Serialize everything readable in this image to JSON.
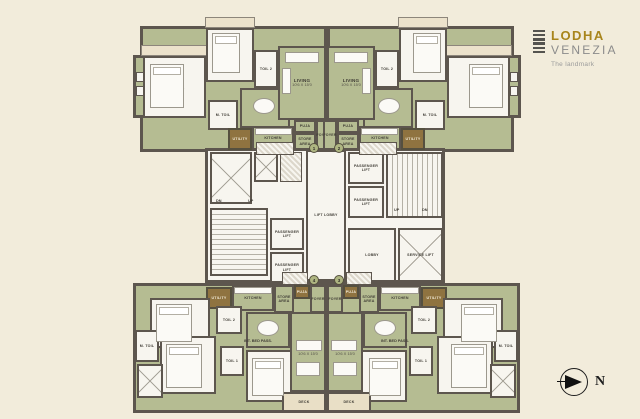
{
  "brand": {
    "line1": "LODHA",
    "line2": "VENEZIA",
    "tagline": "The landmark"
  },
  "compass": {
    "label": "N"
  },
  "flat_numbers": {
    "top_left": "1",
    "top_right": "2",
    "bottom_left": "4",
    "bottom_right": "3"
  },
  "rooms": {
    "m_bed": {
      "label": "M. BED",
      "dims": "11'0 X 10'0"
    },
    "bed2": {
      "label": "BED 2",
      "dims": "10'0 X 11'3"
    },
    "bed3": {
      "label": "BED 3",
      "dims": "10'0 X 10'6"
    },
    "toil1": {
      "label": "TOIL 1",
      "dims": "5'0 X 8'0"
    },
    "toil2": {
      "label": "TOIL 2",
      "dims": "5'0 X 8'0"
    },
    "m_toil": {
      "label": "M. TOIL",
      "dims": "5'0 X 8'0"
    },
    "living": {
      "label": "LIVING",
      "dims": "10'6 X 15'0"
    },
    "dining": {
      "label": "DINING",
      "dims": "8'0 X 8'6"
    },
    "kitchen": {
      "label": "KITCHEN",
      "dims": "10'6 X 8'0"
    },
    "utility": {
      "label": "UTILITY"
    },
    "puja": {
      "label": "PUJA"
    },
    "store": {
      "label": "STORE\nAREA"
    },
    "foyer": {
      "label": "FOYER"
    },
    "deck": {
      "label": "DECK",
      "dims": "10'0 X 4'0"
    },
    "pass": {
      "label": "INT. BED PASS."
    }
  },
  "core": {
    "passenger_lift": "PASSENGER\nLIFT",
    "service_lift": "SERVICE LIFT",
    "lift_lobby": "LIFT LOBBY",
    "lobby": "LOBBY",
    "up": "UP",
    "dn": "DN"
  },
  "colors": {
    "background": "#f2ecdb",
    "room_green": "#b5bc92",
    "wall": "#5d564e",
    "white_room": "#f7f5ef",
    "utility_brown": "#8f7340",
    "deck_beige": "#e9dfc6",
    "brand_gold": "#a8851c",
    "brand_gray": "#8b8b8b"
  }
}
